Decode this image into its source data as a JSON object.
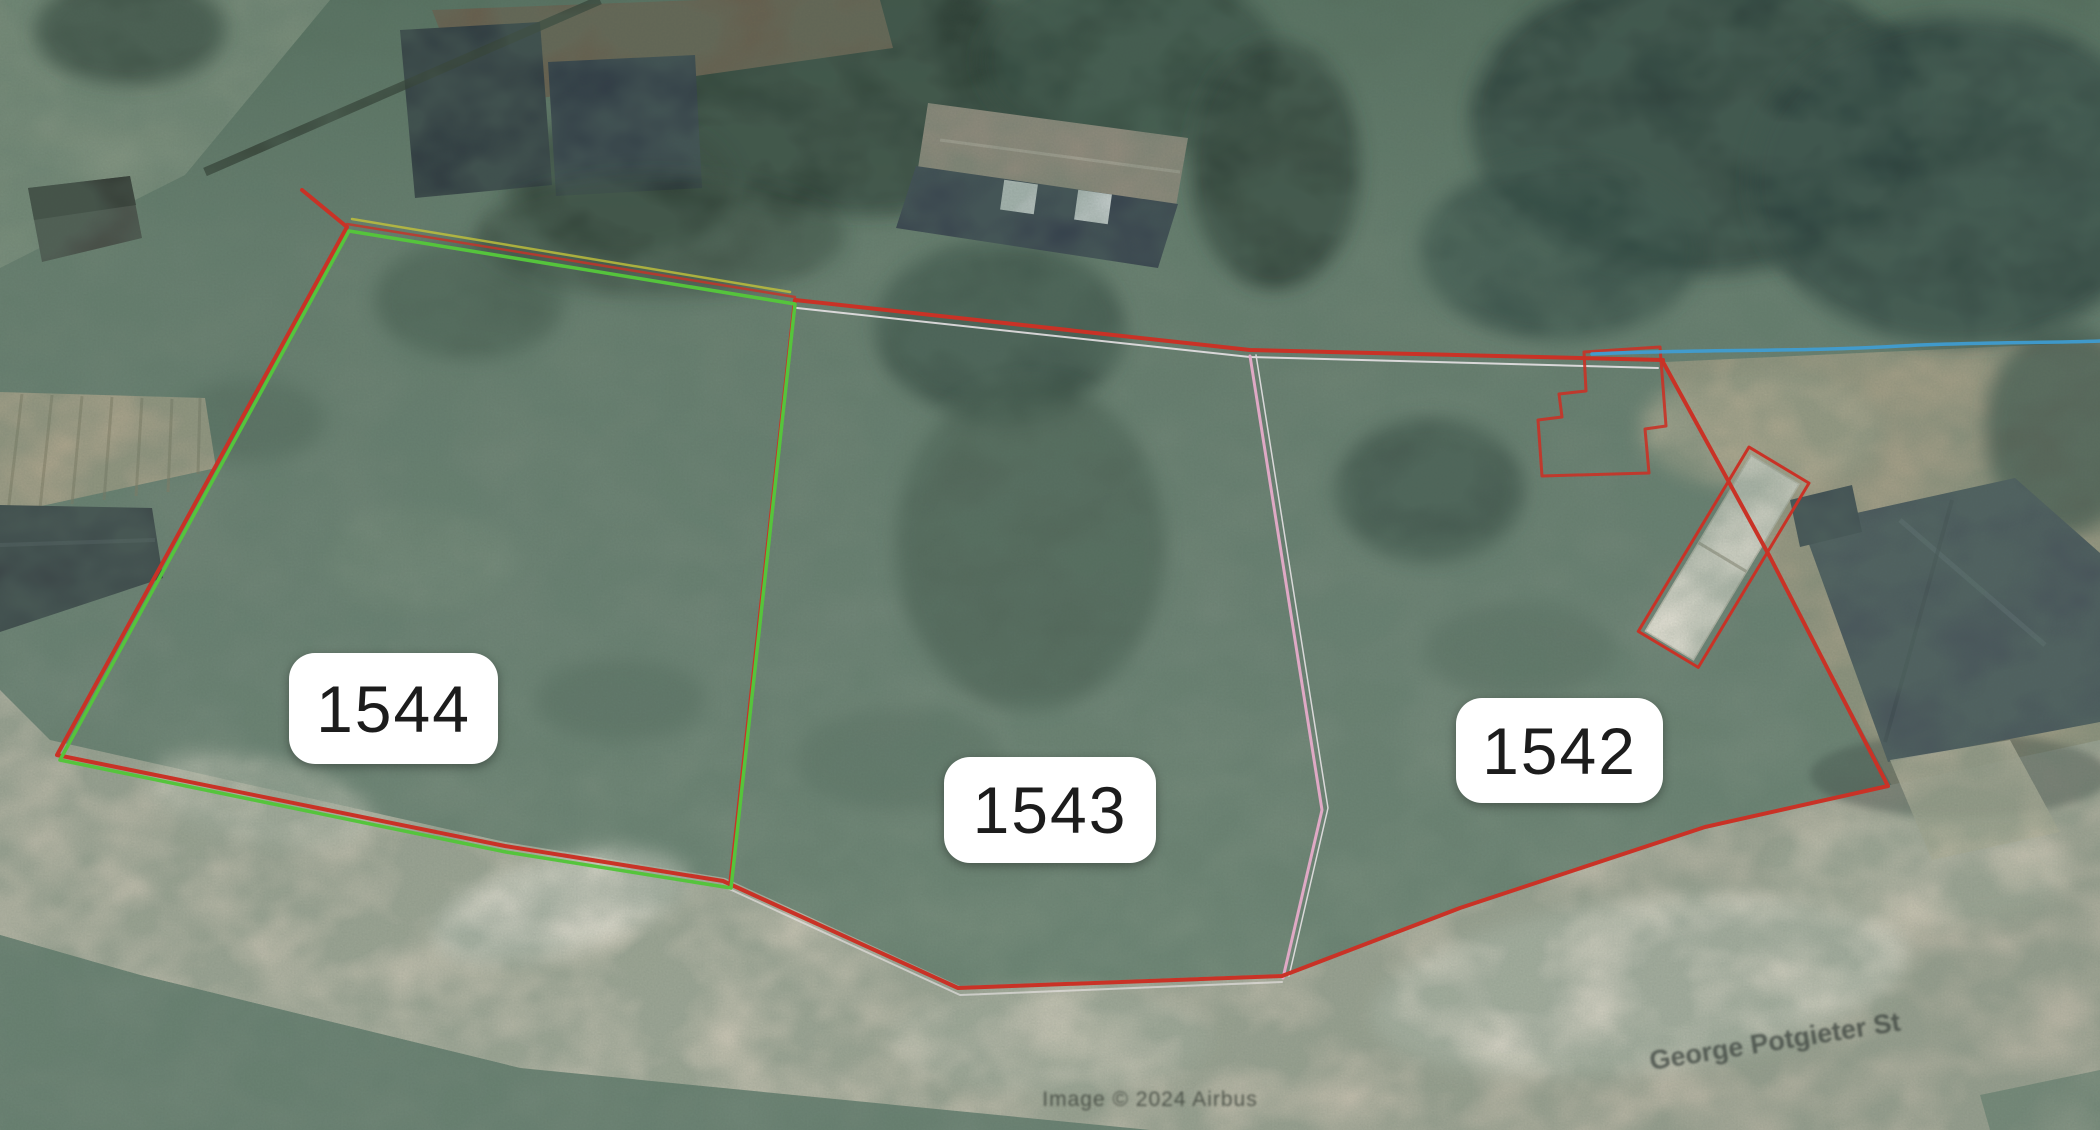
{
  "map": {
    "type": "satellite-parcel-view",
    "attribution": "Image © 2024 Airbus",
    "street_label": "George Potgieter St"
  },
  "parcels": [
    {
      "id": "1544",
      "label": "1544",
      "outline": "green-red"
    },
    {
      "id": "1543",
      "label": "1543",
      "outline": "red-pink"
    },
    {
      "id": "1542",
      "label": "1542",
      "outline": "red"
    }
  ],
  "colors": {
    "boundary_red": "#c93226",
    "parcel_green": "#55c43c",
    "divider_pink": "#dfa9c5",
    "divider_white": "#efe9ec",
    "waterline_blue": "#3e9ed6",
    "survey_yellow": "#c3c33a",
    "label_bg": "#ffffff",
    "label_text": "#1c1c1c"
  }
}
